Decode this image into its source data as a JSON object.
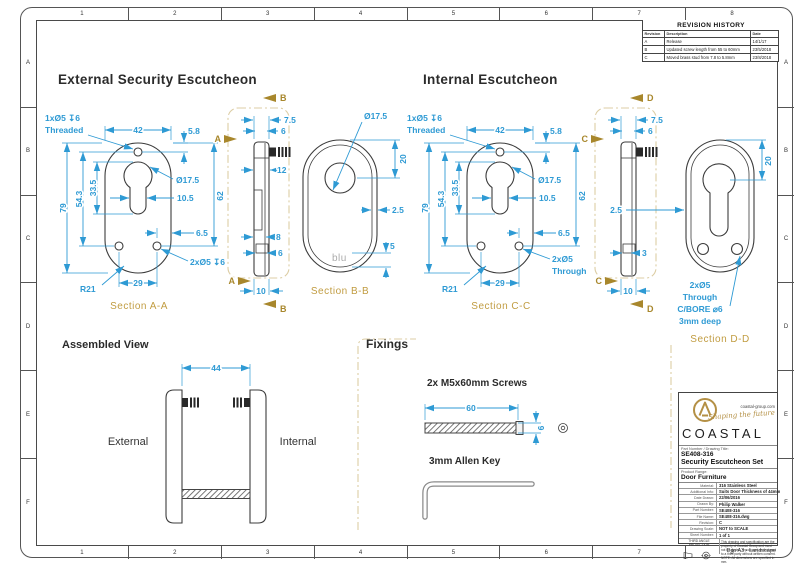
{
  "frame": {
    "columns": [
      "1",
      "2",
      "3",
      "4",
      "5",
      "6",
      "7",
      "8"
    ],
    "rows": [
      "A",
      "B",
      "C",
      "D",
      "E",
      "F"
    ],
    "paper_note": "D in A3 - Landscape"
  },
  "revision_history": {
    "title": "REVISION HISTORY",
    "columns": [
      "Revision",
      "Description",
      "Date"
    ],
    "rows": [
      {
        "revision": "A",
        "description": "Release",
        "date": "14/1/17"
      },
      {
        "revision": "B",
        "description": "Updated screw length from 55 to 60mm",
        "date": "23/5/2018"
      },
      {
        "revision": "C",
        "description": "Moved brass stud from 7.8 to 5.8mm",
        "date": "23/8/2018"
      }
    ]
  },
  "external": {
    "heading": "External Security Escutcheon",
    "front": {
      "caption": "Section A-A",
      "hole_note_line1": "1xØ5 ↧6",
      "hole_note_line2": "Threaded",
      "dim_width": "42",
      "dim_top_offset": "5.8",
      "dim_height": "79",
      "dim_holes_span": "54.3",
      "dim_slot_span": "33.5",
      "dim_cylinder_dia": "Ø17.5",
      "dim_slot_width": "10.5",
      "dim_inner_height": "62",
      "dim_edge_offset": "6.5",
      "dim_bottom_holes": "2xØ5 ↧6",
      "dim_radius": "R21",
      "dim_holes_width": "29"
    },
    "side": {
      "dim_total_thickness": "7.5",
      "dim_body_thickness": "6",
      "dim_stud_length": "12",
      "dim_recess": "8",
      "dim_lower": "6",
      "dim_base": "10",
      "label_a": "A",
      "label_b": "B"
    },
    "section_bb": {
      "caption": "Section B-B",
      "dim_cylinder_dia": "Ø17.5",
      "dim_hole_top": "20",
      "dim_wall": "2.5",
      "dim_logo_offset": "5",
      "engraving": "blu"
    }
  },
  "internal": {
    "heading": "Internal Escutcheon",
    "front": {
      "caption": "Section C-C",
      "hole_note_line1": "1xØ5 ↧6",
      "hole_note_line2": "Threaded",
      "dim_width": "42",
      "dim_top_offset": "5.8",
      "dim_height": "79",
      "dim_holes_span": "54.3",
      "dim_slot_span": "33.5",
      "dim_cylinder_dia": "Ø17.5",
      "dim_slot_width": "10.5",
      "dim_inner_height": "62",
      "dim_edge_offset": "6.5",
      "dim_bottom_holes_line1": "2xØ5",
      "dim_bottom_holes_line2": "Through",
      "dim_radius": "R21",
      "dim_holes_width": "29"
    },
    "side": {
      "dim_total_thickness": "7.5",
      "dim_body_thickness": "6",
      "dim_stud": "3",
      "dim_base": "10",
      "label_c": "C",
      "label_d": "D"
    },
    "section_dd": {
      "caption": "Section D-D",
      "dim_hole_top": "20",
      "dim_wall": "2.5",
      "note_line1": "2xØ5",
      "note_line2": "Through",
      "note_line3": "C/BORE ⌀6",
      "note_line4": "3mm deep"
    }
  },
  "assembled": {
    "title": "Assembled View",
    "dim_gap": "44",
    "left_label": "External",
    "right_label": "Internal"
  },
  "fixings": {
    "title": "Fixings",
    "screws_label": "2x M5x60mm Screws",
    "dim_screw_length": "60",
    "dim_screw_dia": "6",
    "allen_label": "3mm Allen Key"
  },
  "title_block": {
    "brand": {
      "name": "COASTAL",
      "website": "coastal-group.com",
      "tagline": "Shaping the future"
    },
    "part_title_label": "Part Number / Drawing Title:",
    "part_number": "SE408-316",
    "drawing_title": "Security Escutcheon Set",
    "product_range_label": "Product Range:",
    "product_range": "Door Furniture",
    "fields": [
      {
        "label": "Material:",
        "value": "316 Stainless Steel"
      },
      {
        "label": "Additional Info:",
        "value": "Suits Door Thickness of 44mm"
      },
      {
        "label": "Date Drawn:",
        "value": "22/06/2016"
      },
      {
        "label": "Drawn By:",
        "value": "Philip Walker"
      },
      {
        "label": "Part Number:",
        "value": "SE408-316"
      },
      {
        "label": "File Name:",
        "value": "SE408-316.dwg"
      },
      {
        "label": "Revision:",
        "value": "C"
      },
      {
        "label": "Drawing Scale:",
        "value": "NOT to SCALE"
      },
      {
        "label": "Sheet Number:",
        "value": "1 of 1"
      }
    ],
    "projection_label": "THIRD ANGLE PROJECTION",
    "disclaimer": "This drawing and specification are the property of Coastal Group and must not be copied, reproduced or disclosed to a third party without written consent. NOTE: All dimensions are specified in mm."
  }
}
